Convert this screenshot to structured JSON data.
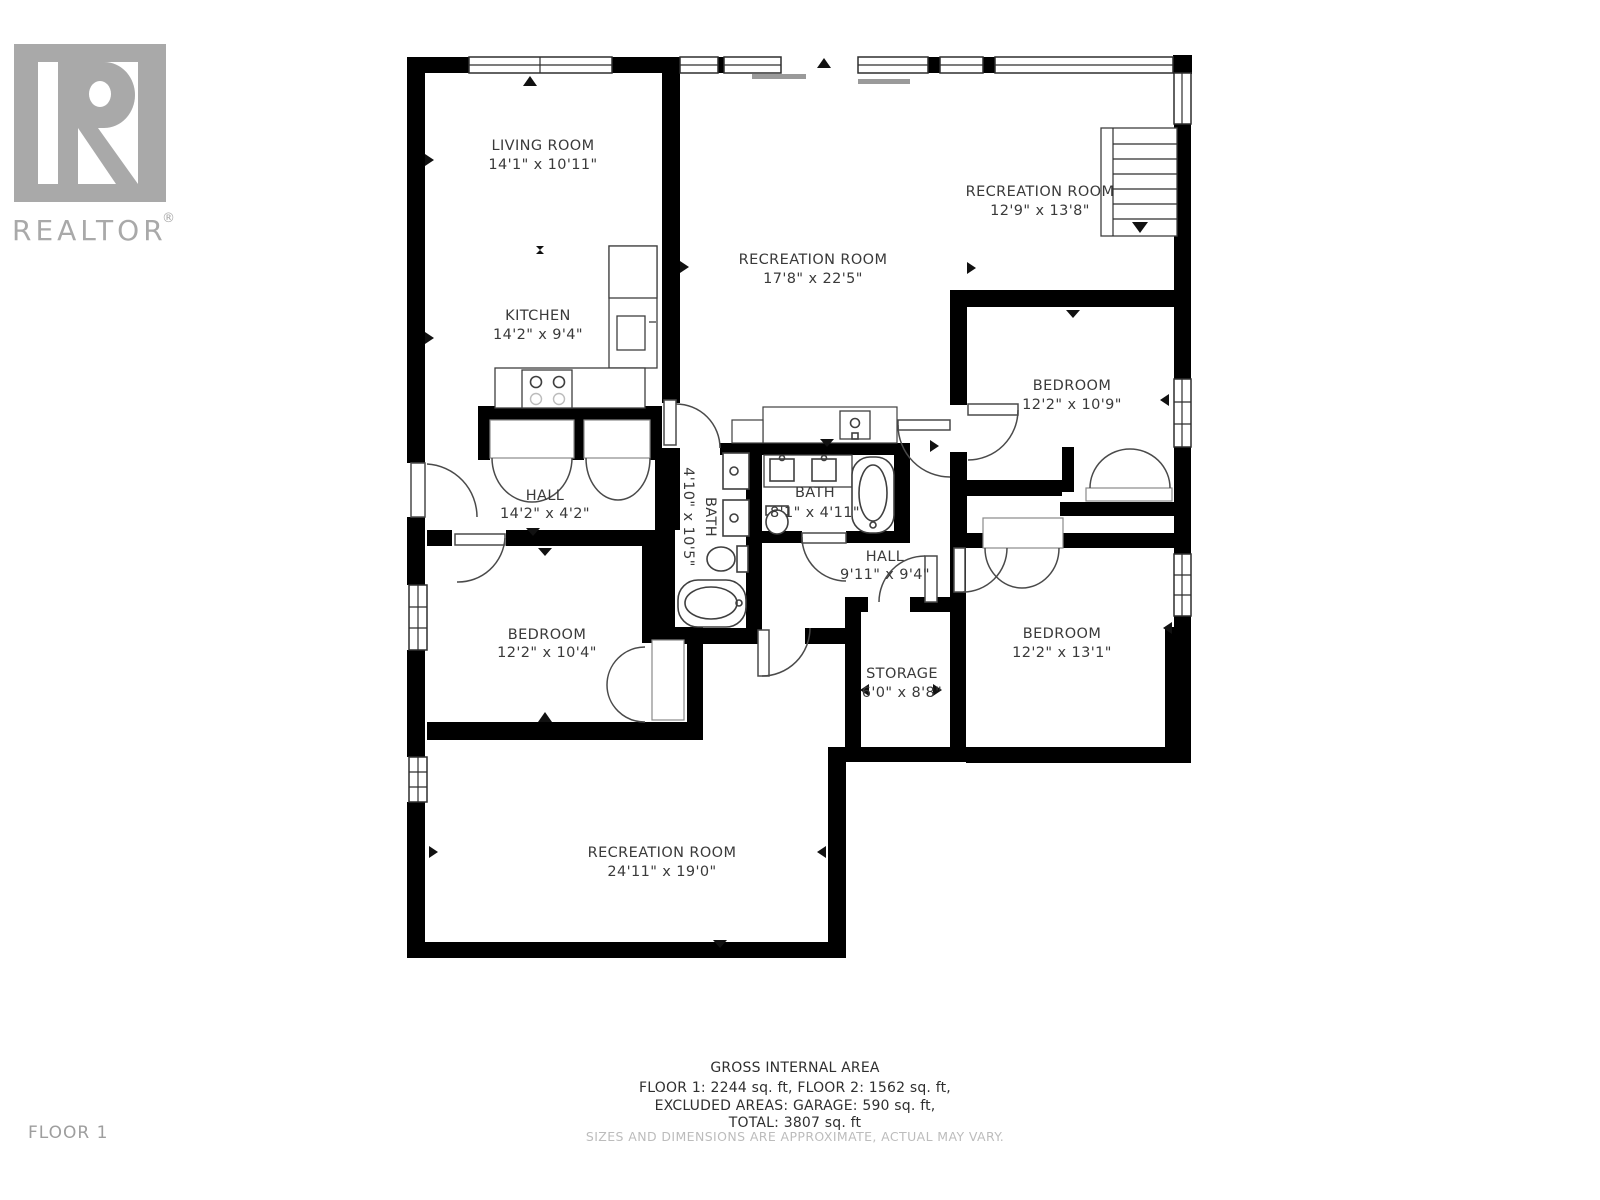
{
  "brand": {
    "name": "REALTOR",
    "registered": "®",
    "logo_color": "#a9a9a9"
  },
  "floor_label": "FLOOR 1",
  "colors": {
    "wall": "#000000",
    "background": "#ffffff",
    "label_text": "#3a3a3a",
    "muted_text": "#bcbcbc",
    "logo_gray": "#a9a9a9"
  },
  "rooms": [
    {
      "id": "living-room",
      "name": "LIVING ROOM",
      "dims": "14'1\" x 10'11\""
    },
    {
      "id": "kitchen",
      "name": "KITCHEN",
      "dims": "14'2\" x 9'4\""
    },
    {
      "id": "recreation-room-main",
      "name": "RECREATION ROOM",
      "dims": "17'8\" x 22'5\""
    },
    {
      "id": "recreation-room-upper",
      "name": "RECREATION ROOM",
      "dims": "12'9\" x 13'8\""
    },
    {
      "id": "bedroom-right-upper",
      "name": "BEDROOM",
      "dims": "12'2\" x 10'9\""
    },
    {
      "id": "hall-upper",
      "name": "HALL",
      "dims": "14'2\" x 4'2\""
    },
    {
      "id": "bath-left",
      "name": "BATH",
      "dims": "4'10\" x 10'5\""
    },
    {
      "id": "bath-center",
      "name": "BATH",
      "dims": "8'1\" x 4'11\""
    },
    {
      "id": "hall-center",
      "name": "HALL",
      "dims": "9'11\" x 9'4\""
    },
    {
      "id": "bedroom-left",
      "name": "BEDROOM",
      "dims": "12'2\" x 10'4\""
    },
    {
      "id": "storage",
      "name": "STORAGE",
      "dims": "6'0\" x 8'8\""
    },
    {
      "id": "bedroom-right-lower",
      "name": "BEDROOM",
      "dims": "12'2\" x 13'1\""
    },
    {
      "id": "recreation-room-lower",
      "name": "RECREATION ROOM",
      "dims": "24'11\" x 19'0\""
    }
  ],
  "footer": {
    "title": "GROSS INTERNAL AREA",
    "line1": "FLOOR 1: 2244 sq. ft, FLOOR 2: 1562 sq. ft,",
    "line2": "EXCLUDED AREAS: GARAGE: 590 sq. ft,",
    "line3": "TOTAL: 3807 sq. ft",
    "disclaimer": "SIZES AND DIMENSIONS ARE APPROXIMATE, ACTUAL MAY VARY."
  }
}
